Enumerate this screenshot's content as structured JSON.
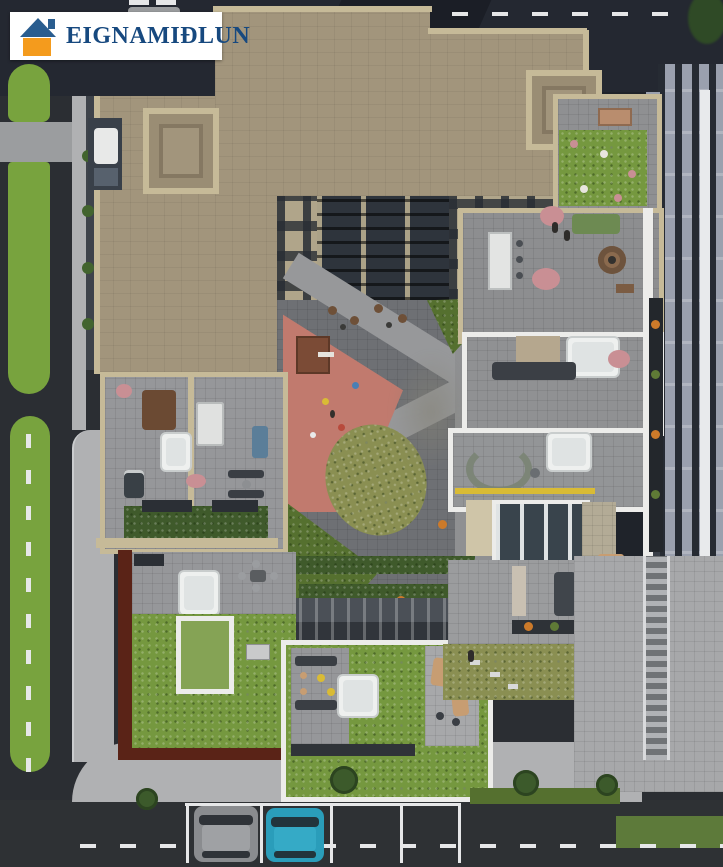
{
  "logo": {
    "text": "EIGNAMIÐLUN"
  },
  "icons": {
    "house": "css-triangle-and-square",
    "bicycle": "inline-svg-bicycle",
    "road_arrow": "css-straight-ahead-arrow"
  },
  "scene_objects": {
    "driving_car": "lime-green car on left street",
    "parked_car_1": "grey SUV in bottom parking bay",
    "parked_car_2": "teal car in bottom parking bay",
    "playground": "red safety surface with climbing frame and balls",
    "hot_tubs": 4,
    "fire_pit": 1,
    "light_wells": 2
  },
  "palette": {
    "asphalt": "#2b2e33",
    "asphaltTop": "#242831",
    "asphaltBottom": "#2e3134",
    "alley": "#1f232a",
    "marking": "#e6e7e8",
    "grass": "#78a33e",
    "sidewalk": "#b0b1b3",
    "paver": "#a7a8aa",
    "roofBeige": "#a2957c",
    "roofBeigeLight": "#c6ba98",
    "facadeBeige": "#b0a58a",
    "windowDark": "#363b42",
    "courtFloor": "#6e7074",
    "path": "#97989a",
    "playgroundRed": "#c17a6e",
    "bedGreen": "#55702f",
    "hedge": "#3f5a2b",
    "lawnOlive": "#8a8f52",
    "greenRoof": "#75983f",
    "maroon": "#5a2317",
    "whiteTrim": "#ececea",
    "terrace": "#96979a",
    "neighborGrey": "#9aa0ae",
    "neighborDark": "#262b33",
    "neighborSide": "#3a3f48",
    "sofaGreen": "#6d8a52",
    "firePit": "#8a6a4e",
    "accentYellow": "#d9bb35",
    "carLime": "#b5c43c",
    "carGrey": "#8a8c8f",
    "carTeal": "#2a9dba",
    "tree": "#3c5a2b",
    "flowerPink": "#c98f94",
    "flowerOrange": "#cc7a2a",
    "hotTub": "#eef0ef",
    "woodBrown": "#6b4a33",
    "logoRoof": "#2a5d8f",
    "logoBody": "#f49b1d",
    "logoText": "#17497f",
    "logoBg": "#ffffff"
  }
}
